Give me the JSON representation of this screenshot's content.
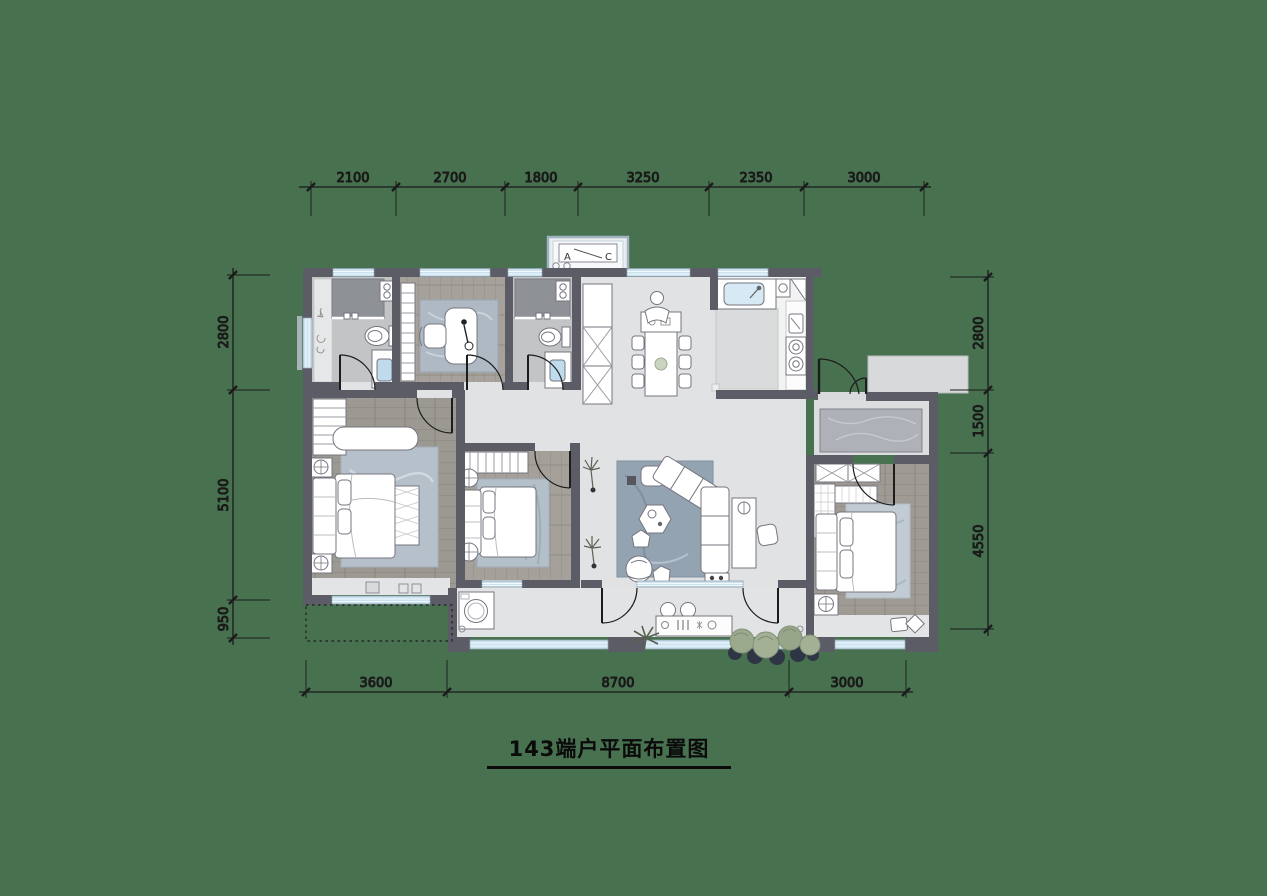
{
  "title": "143端户平面布置图",
  "dims": {
    "top": [
      "2100",
      "2700",
      "1800",
      "3250",
      "2350",
      "3000"
    ],
    "left": [
      "2800",
      "5100",
      "950"
    ],
    "right": [
      "2800",
      "1500",
      "4550"
    ],
    "bottom": [
      "3600",
      "8700",
      "3000"
    ]
  },
  "ac_platform": {
    "label_a": "A",
    "label_c": "C"
  },
  "palette": {
    "background": "#47714F",
    "wall": "#5C5C67",
    "window_glass": "#CBE2F0",
    "open_floor_marble": "#E0E2E4",
    "wood_floor": "#9C9992",
    "bath_floor": "#C2C4C6",
    "shower_marble": "#8E9196",
    "rug_blue": "#93A3B2",
    "greenery": "#9BA98D",
    "dimension_line": "#1B1B1B"
  }
}
